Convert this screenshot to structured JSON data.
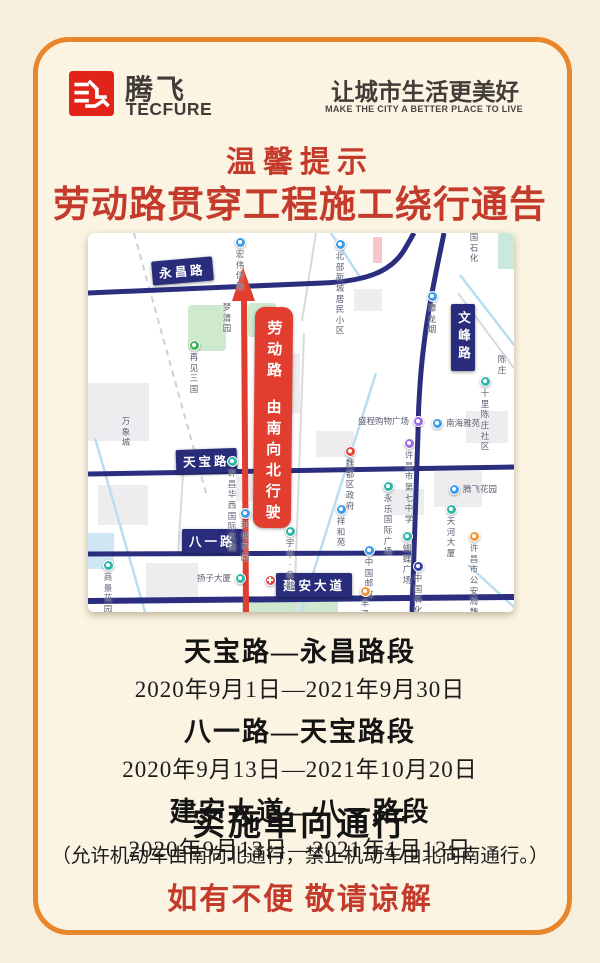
{
  "brand": {
    "name_cn": "腾飞",
    "name_en": "TECFURE",
    "slogan_cn": "让城市生活更美好",
    "slogan_en": "MAKE THE CITY A BETTER PLACE TO LIVE"
  },
  "notice": {
    "tip": "温馨提示",
    "title": "劳动路贯穿工程施工绕行通告",
    "sections": [
      {
        "road": "天宝路—永昌路段",
        "dates": "2020年9月1日—2021年9月30日"
      },
      {
        "road": "八一路—天宝路段",
        "dates": "2020年9月13日—2021年10月20日"
      },
      {
        "road": "建安大道—八一路段",
        "dates": "2020年9月13日—2021年1月13日"
      }
    ],
    "policy": "实施单向通行",
    "policy_detail": "（允许机动车由南向北通行，禁止机动车由北向南通行。）",
    "apology": "如有不便 敬请谅解"
  },
  "map": {
    "detour": {
      "line1": "劳动路",
      "line2": "由南向北行驶"
    },
    "road_labels": [
      {
        "text": "永昌路",
        "x": 64,
        "y": 26,
        "rot": -5,
        "vertical": false
      },
      {
        "text": "天宝路",
        "x": 88,
        "y": 216,
        "rot": -2,
        "vertical": false
      },
      {
        "text": "八一路",
        "x": 94,
        "y": 296,
        "rot": 0,
        "vertical": false
      },
      {
        "text": "建安大道",
        "x": 188,
        "y": 340,
        "rot": 0,
        "vertical": false
      },
      {
        "text": "文峰路",
        "x": 363,
        "y": 71,
        "rot": 0,
        "vertical": true
      }
    ],
    "pois": [
      {
        "name": "宏伟佳苑",
        "x": 152,
        "y": 9,
        "pin": "blue",
        "label": "below"
      },
      {
        "name": "北部新城\n居民小区",
        "x": 252,
        "y": 11,
        "pin": "blue",
        "label": "below"
      },
      {
        "name": "国石化",
        "x": 386,
        "y": 4,
        "pin": "none",
        "label": "below"
      },
      {
        "name": "梦清园",
        "x": 139,
        "y": 74,
        "pin": "none",
        "label": "below"
      },
      {
        "name": "再见三国",
        "x": 106,
        "y": 112,
        "pin": "green",
        "label": "below"
      },
      {
        "name": "万象城",
        "x": 38,
        "y": 188,
        "pin": "none",
        "label": "below"
      },
      {
        "name": "潭龙烟",
        "x": 344,
        "y": 63,
        "pin": "blue",
        "label": "below"
      },
      {
        "name": "陈庄",
        "x": 414,
        "y": 126,
        "pin": "none",
        "label": "below"
      },
      {
        "name": "十里陈庄社区",
        "x": 397,
        "y": 148,
        "pin": "teal",
        "label": "below"
      },
      {
        "name": "盛程购物广场",
        "x": 330,
        "y": 188,
        "pin": "purple",
        "label": "left"
      },
      {
        "name": "南海雅苑",
        "x": 349,
        "y": 190,
        "pin": "blue",
        "label": "right"
      },
      {
        "name": "许昌华西\n国际花园",
        "x": 144,
        "y": 228,
        "pin": "teal",
        "label": "below"
      },
      {
        "name": "魏都区政府",
        "x": 262,
        "y": 218,
        "pin": "red",
        "label": "below"
      },
      {
        "name": "许昌市第七中学",
        "x": 321,
        "y": 210,
        "pin": "purple",
        "label": "below"
      },
      {
        "name": "永乐国际广场",
        "x": 300,
        "y": 253,
        "pin": "teal",
        "label": "below"
      },
      {
        "name": "祥和苑",
        "x": 253,
        "y": 276,
        "pin": "blue",
        "label": "below"
      },
      {
        "name": "腾飞花园",
        "x": 366,
        "y": 256,
        "pin": "blue",
        "label": "right"
      },
      {
        "name": "天河大厦",
        "x": 363,
        "y": 276,
        "pin": "teal",
        "label": "below"
      },
      {
        "name": "和谐家园",
        "x": 157,
        "y": 280,
        "pin": "blue",
        "label": "below"
      },
      {
        "name": "宇华·名都",
        "x": 202,
        "y": 298,
        "pin": "teal",
        "label": "below"
      },
      {
        "name": "蝴蝶广场",
        "x": 319,
        "y": 303,
        "pin": "teal",
        "label": "below"
      },
      {
        "name": "许昌市公安局\n魏都分局",
        "x": 386,
        "y": 303,
        "pin": "orange",
        "label": "below"
      },
      {
        "name": "商景花园",
        "x": 20,
        "y": 332,
        "pin": "teal",
        "label": "below"
      },
      {
        "name": "扬子大厦",
        "x": 152,
        "y": 345,
        "pin": "teal",
        "label": "left"
      },
      {
        "name": "中国邮政",
        "x": 281,
        "y": 317,
        "pin": "blue",
        "label": "below"
      },
      {
        "name": "中国石化",
        "x": 330,
        "y": 333,
        "pin": "navy",
        "label": "below"
      },
      {
        "name": "丰泽园饭店",
        "x": 277,
        "y": 358,
        "pin": "orange",
        "label": "below"
      },
      {
        "name": "",
        "x": 182,
        "y": 347,
        "pin": "redcross",
        "label": "below"
      }
    ],
    "pin_colors": {
      "blue": "#3d9bea",
      "teal": "#2eb6a8",
      "green": "#43b25d",
      "purple": "#9d6be0",
      "red": "#e0483e",
      "orange": "#f2983a",
      "navy": "#3d43a0",
      "redcross": "#e0483e"
    }
  },
  "colors": {
    "frame": "#e8862c",
    "background": "#f7efdc",
    "panel": "#fbf4e3",
    "accent_red": "#c43b2c",
    "road_navy": "#2b2e7e",
    "detour_red": "#e23e30",
    "logo_red": "#e2231a"
  }
}
